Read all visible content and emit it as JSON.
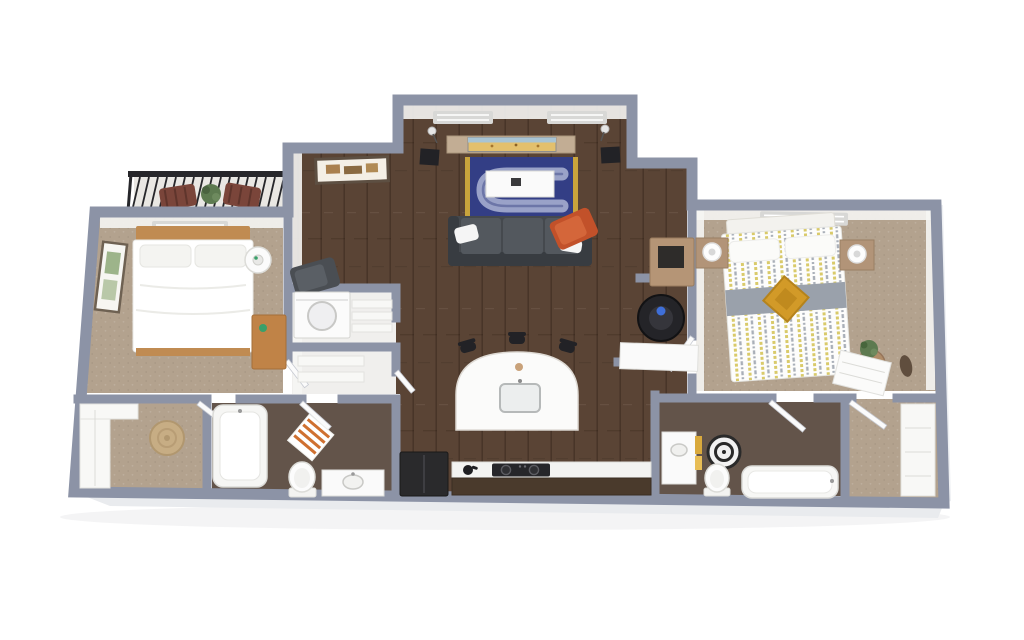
{
  "meta": {
    "description": "3D rendered isometric floor plan of a two-bedroom, two-bathroom apartment with balcony, open living room and kitchen",
    "style": "photoreal 3D dollhouse floor plan on white background",
    "background": "#ffffff",
    "visible_text": ""
  },
  "palette": {
    "wall": "#8c93a6",
    "wallFace": "#f5f5f3",
    "slab": "#e9ebee",
    "wood": "#5a4435",
    "carpet": "#b3a28e",
    "bathFloor": "#63544a",
    "utilFloor": "#f0efed",
    "balconyFloor": "#e9e7e3",
    "vent": "#d8d8d6",
    "doorFill": "#fbfbfb",
    "black": "#222226",
    "railing": "#26262a",
    "chairBrown": "#7a453a",
    "plant": "#5d7a50",
    "consoleTan": "#c2ad94",
    "tvSand": "#e3c06d",
    "tvSky": "#a8c4d4",
    "rugBlue": "#333e85",
    "rugLight": "#9aa2c8",
    "rugYellow": "#c9a43c",
    "sofa": "#45494e",
    "sofaDark": "#383c41",
    "cushion": "#53585e",
    "pillow": "#f5f5f5",
    "orange": "#c2512a",
    "headboard": "#c08b52",
    "deskWood": "#c08347",
    "nightstand": "#b29478",
    "grayBand": "#9aa1ab",
    "mustard": "#d29a28",
    "stripeYellow": "#d9ca6a",
    "stripeGray": "#a9afb8",
    "counter": "#f3f3f1",
    "cabinet": "#4a3a2c",
    "towelYellow": "#d9a93c",
    "matOrange": "#cf7030",
    "jute": "#c7ad84"
  },
  "rooms": [
    {
      "id": "balcony",
      "name": "Balcony",
      "floor": "concrete",
      "furniture": [
        "metal railing",
        "two wood patio chairs",
        "potted plant"
      ]
    },
    {
      "id": "bedroom1",
      "name": "Bedroom 1",
      "floor": "carpet",
      "furniture": [
        "queen bed with white duvet and wood headboard",
        "round lamp table",
        "wood desk",
        "framed wall art",
        "ceiling vent"
      ]
    },
    {
      "id": "living-room",
      "name": "Living / Dining Room",
      "floor": "hardwood",
      "furniture": [
        "TV console with flat TV",
        "two floor lamps",
        "two black speakers",
        "blue area rug with yellow border stripes",
        "white coffee table",
        "dark gray sofa with white pillows",
        "orange accent chair",
        "dark reading chair",
        "framed wall art",
        "two ceiling vents"
      ]
    },
    {
      "id": "laundry-closet",
      "name": "Laundry Closet",
      "floor": "vinyl",
      "furniture": [
        "washer",
        "wire shelves"
      ]
    },
    {
      "id": "linen-closet",
      "name": "Linen Closet",
      "floor": "vinyl",
      "furniture": [
        "shelves",
        "bifold door"
      ]
    },
    {
      "id": "walk-in-closet-1",
      "name": "Walk-in Closet 1",
      "floor": "carpet",
      "furniture": [
        "white shelving",
        "round jute rug"
      ]
    },
    {
      "id": "bathroom1",
      "name": "Bathroom 1",
      "floor": "dark tile",
      "furniture": [
        "bathtub",
        "toilet",
        "vanity with sink",
        "orange striped bath mat"
      ]
    },
    {
      "id": "kitchen",
      "name": "Kitchen",
      "floor": "hardwood",
      "furniture": [
        "curved white island with sink",
        "three black bar stools",
        "black refrigerator",
        "white counter with black cooktop",
        "dark lower cabinets",
        "black kettle"
      ]
    },
    {
      "id": "hall-nook",
      "name": "Hall Nook",
      "floor": "hardwood",
      "furniture": [
        "tan bar cabinet with black box",
        "black trash can",
        "white sideboard"
      ]
    },
    {
      "id": "bedroom2",
      "name": "Bedroom 2",
      "floor": "carpet",
      "furniture": [
        "queen bed with yellow-gray striped duvet",
        "gray runner with mustard accent pillow",
        "two tan nightstands with white lamps",
        "round side table with plant",
        "white dresser",
        "oval wall decor",
        "ceiling vent"
      ]
    },
    {
      "id": "bathroom2",
      "name": "Bathroom 2",
      "floor": "dark tile",
      "furniture": [
        "vanity with sink and yellow towels",
        "black and white striped round rug",
        "toilet",
        "bathtub"
      ]
    },
    {
      "id": "walk-in-closet-2",
      "name": "Walk-in Closet 2",
      "floor": "carpet",
      "furniture": [
        "white shelving"
      ]
    }
  ]
}
